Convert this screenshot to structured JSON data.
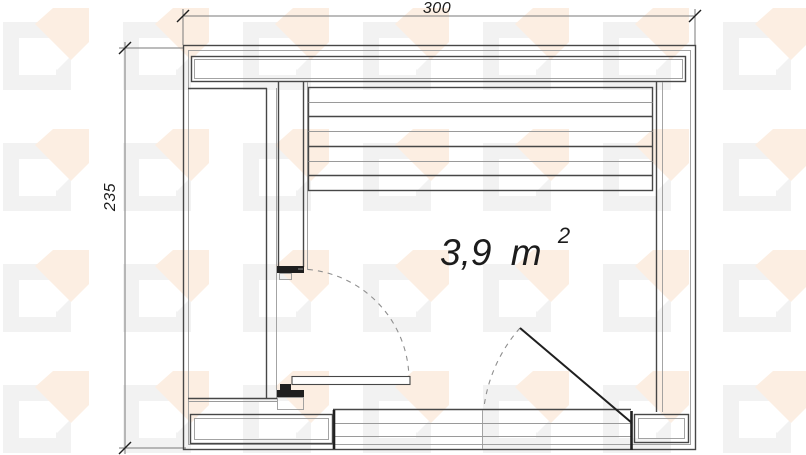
{
  "drawing": {
    "dimensions": {
      "top": "300",
      "left": "235"
    },
    "area": {
      "value": "3,9",
      "unit": "m",
      "superscript": "2"
    },
    "bench": {
      "slat_count": 7
    },
    "colors": {
      "line_dark": "#474747",
      "line_light": "#9a9a9a",
      "line_black": "#1f1f1f",
      "line_dim": "#7a7a7a",
      "dash": "#8f8f8f",
      "text": "#1c1c1c",
      "watermark_square": "#f2f2f2",
      "watermark_arrow": "#fceee2",
      "background": "#ffffff"
    }
  }
}
